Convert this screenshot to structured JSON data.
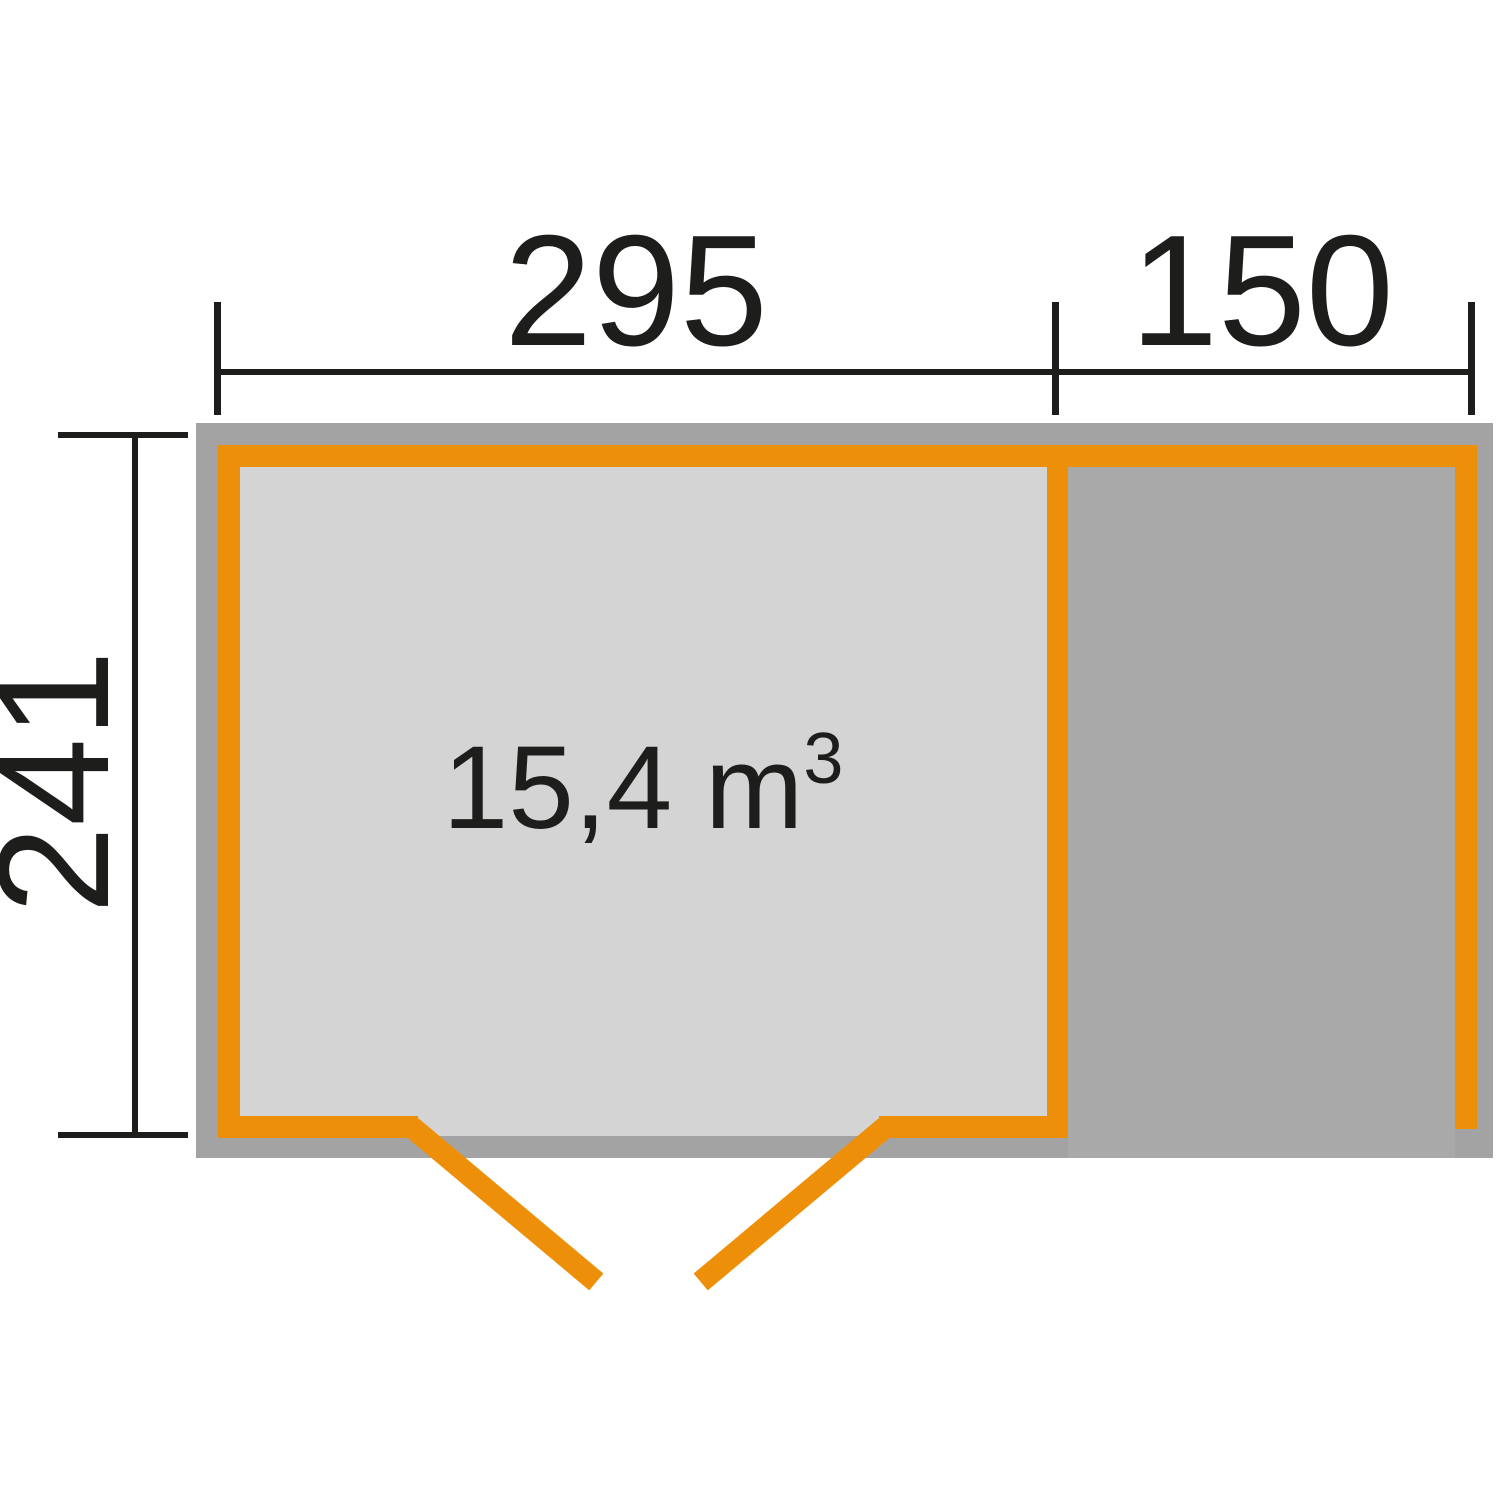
{
  "diagram": {
    "type": "floor-plan",
    "dimensions": [
      {
        "id": "width-main-room",
        "value": "295",
        "orientation": "horizontal"
      },
      {
        "id": "width-annex",
        "value": "150",
        "orientation": "horizontal"
      },
      {
        "id": "depth",
        "value": "241",
        "orientation": "vertical"
      }
    ],
    "room": {
      "volume_text": "15,4 m",
      "volume_exponent": "3"
    },
    "colors": {
      "wall_accent": "#EE8F0A",
      "building_gray": "#A3A3A3",
      "room_fill": "#D4D4D4",
      "annex_fill": "#A9A9A9",
      "dimension_color": "#1D1D1B",
      "background": "#FFFFFF"
    }
  }
}
